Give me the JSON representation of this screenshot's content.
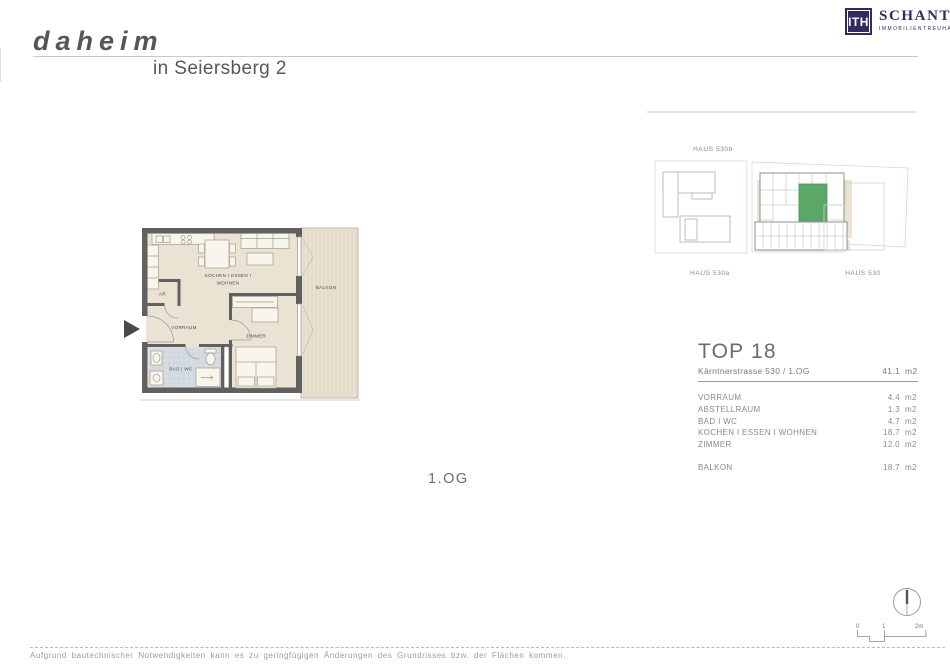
{
  "header": {
    "brand": "daheim",
    "location": "in Seiersberg 2"
  },
  "logo": {
    "icon": "ITH",
    "name": "SCHANTL",
    "tagline": "IMMOBILIENTREUHAND",
    "color": "#312b5f"
  },
  "floor_plan": {
    "level_label": "1.OG",
    "rooms": {
      "kitchen_line1": "KOCHEN I ESSEN I",
      "kitchen_line2": "WOHNEN",
      "ar": "AR",
      "vorraum": "VORRAUM",
      "zimmer": "ZIMMER",
      "bad": "BAD | WC",
      "balkon": "BALKON"
    },
    "colors": {
      "wall": "#606060",
      "floor": "#eae2d2",
      "balcony": "#e9e1cf",
      "bath": "#d6dee4"
    }
  },
  "site_plan": {
    "haus_530b": "HAUS 530b",
    "haus_530a": "HAUS 530a",
    "haus_530": "HAUS 530",
    "highlight_color": "#5aa768"
  },
  "unit_info": {
    "title": "TOP 18",
    "address": "Kärntnerstrasse 530 / 1.OG",
    "total_area": "41.1",
    "unit": "m2",
    "rooms": [
      {
        "name": "VORRAUM",
        "area": "4.4",
        "unit": "m2"
      },
      {
        "name": "ABSTELLRAUM",
        "area": "1.3",
        "unit": "m2"
      },
      {
        "name": "BAD I WC",
        "area": "4.7",
        "unit": "m2"
      },
      {
        "name": "KOCHEN I ESSEN I WOHNEN",
        "area": "18.7",
        "unit": "m2"
      },
      {
        "name": "ZIMMER",
        "area": "12.0",
        "unit": "m2"
      },
      {
        "name": "BALKON",
        "area": "18.7",
        "unit": "m2"
      }
    ]
  },
  "scale_bar": {
    "t0": "0",
    "t1": "1",
    "t2": "2m"
  },
  "footer": {
    "disclaimer": "Aufgrund bautechnischer Notwendigkeiten kann es zu geringfügigen Änderungen des Grundrisses bzw. der Flächen kommen."
  }
}
